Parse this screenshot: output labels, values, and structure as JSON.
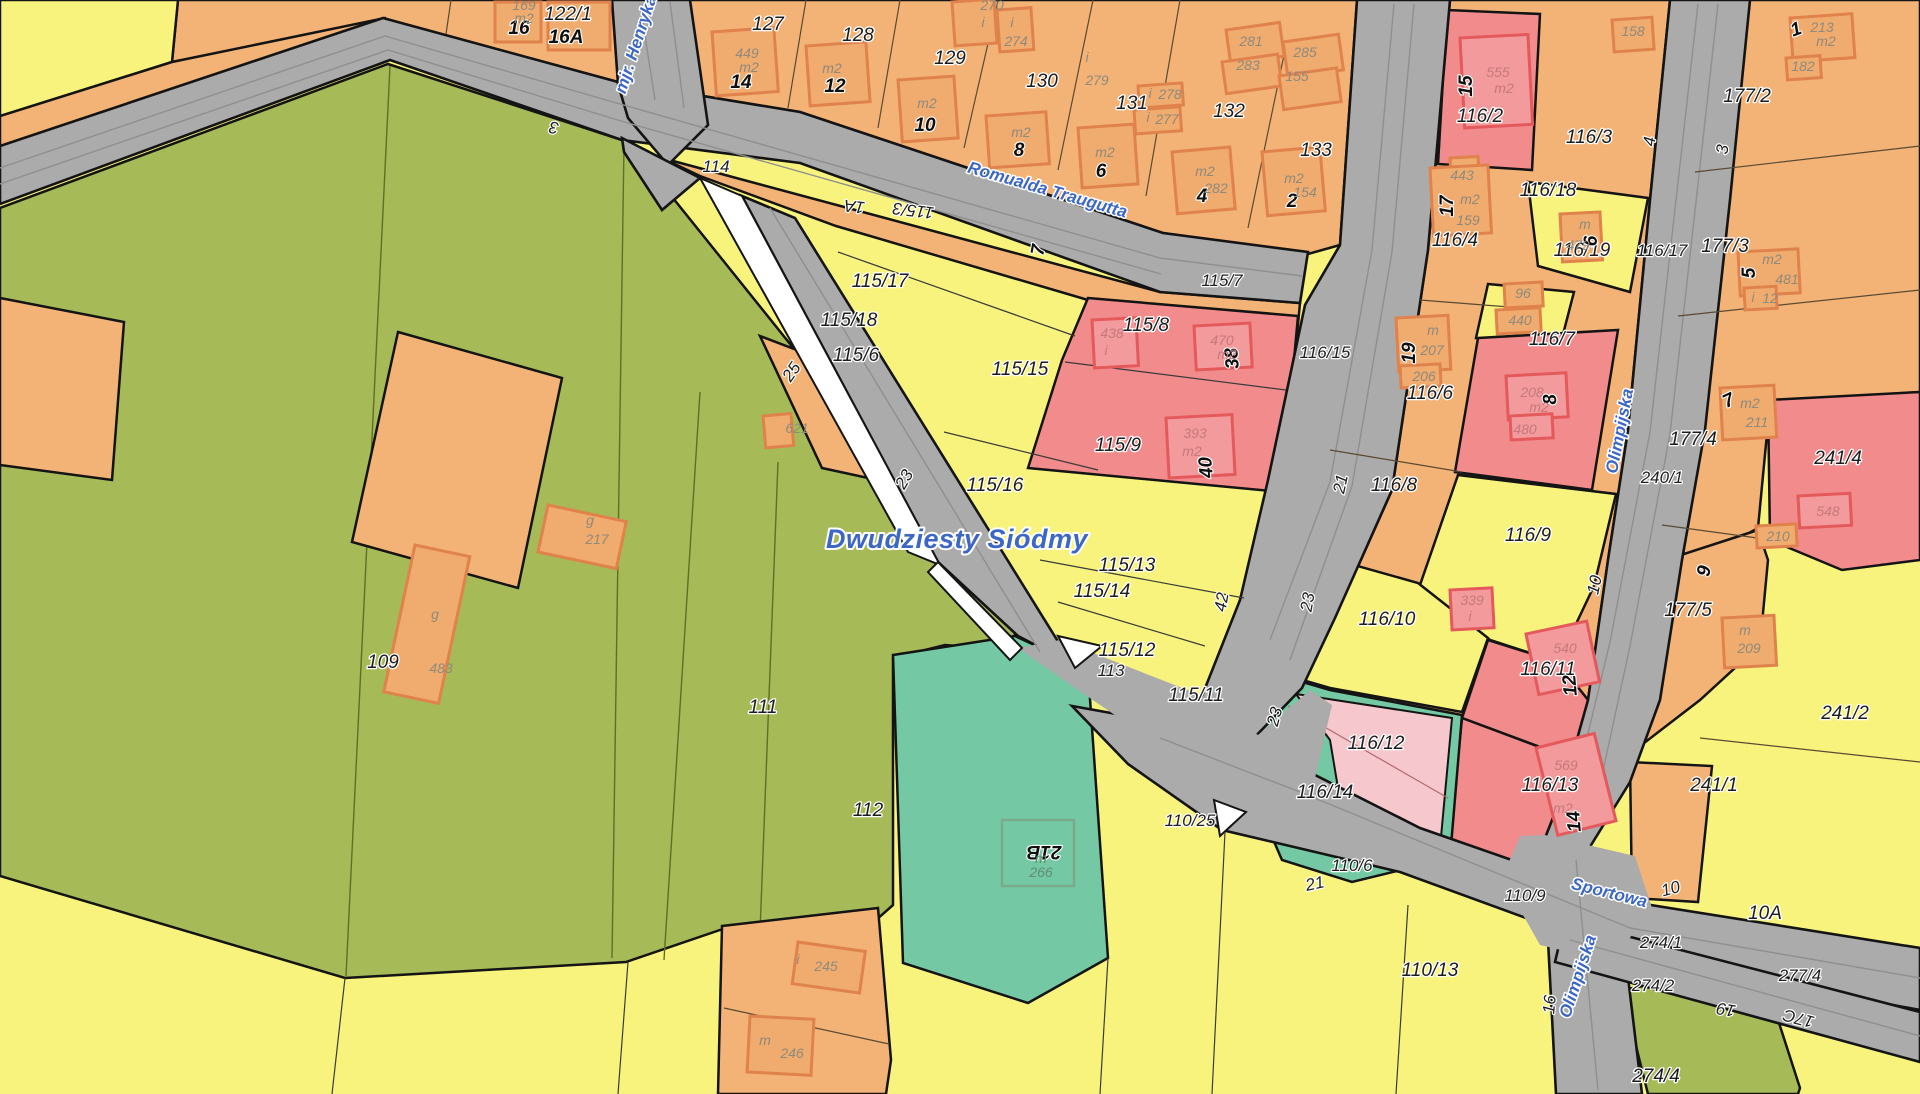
{
  "map": {
    "type": "cadastral-parcel-map",
    "district_label": {
      "text": "Dwudziesty Siódmy",
      "x": 957,
      "y": 548,
      "rot": 0
    }
  },
  "colors": {
    "parcel_yellow": "#f8f37d",
    "parcel_olive": "#a6ba58",
    "parcel_orange": "#f3b377",
    "parcel_red": "#f28b8c",
    "parcel_pink": "#f6c8ce",
    "parcel_teal": "#74c9a4",
    "road_gray": "#ababab",
    "street_text_blue": "#3c67c5",
    "building_outline": "#e0824b"
  },
  "labels": {
    "street_names": [
      [
        "mjr. Henryka",
        641,
        46,
        -72
      ],
      [
        "Romualda Traugutta",
        1046,
        195,
        16
      ],
      [
        "Olimpijska",
        1625,
        432,
        -79
      ],
      [
        "Sportowa",
        1608,
        898,
        14
      ],
      [
        "Olimpijska",
        1583,
        978,
        -72
      ]
    ],
    "district": [
      [
        "Dwudziesty Siódmy",
        957,
        548,
        0
      ]
    ],
    "parcel_numbers": [
      [
        "122/1",
        568,
        20,
        0
      ],
      [
        "127",
        768,
        30,
        0
      ],
      [
        "128",
        858,
        41,
        0
      ],
      [
        "129",
        950,
        64,
        0
      ],
      [
        "130",
        1042,
        87,
        0
      ],
      [
        "131",
        1132,
        109,
        0
      ],
      [
        "132",
        1229,
        117,
        0
      ],
      [
        "133",
        1316,
        156,
        0
      ],
      [
        "116/2",
        1480,
        122,
        0
      ],
      [
        "116/3",
        1589,
        143,
        0
      ],
      [
        "177/2",
        1747,
        102,
        0
      ],
      [
        "116/18",
        1548,
        196,
        0
      ],
      [
        "116/19",
        1582,
        256,
        0
      ],
      [
        "177/3",
        1725,
        252,
        0
      ],
      [
        "116/4",
        1455,
        246,
        0
      ],
      [
        "115/8",
        1146,
        331,
        0
      ],
      [
        "115/15",
        1020,
        375,
        0
      ],
      [
        "115/17",
        880,
        287,
        0
      ],
      [
        "115/18",
        849,
        326,
        0
      ],
      [
        "115/6",
        856,
        361,
        0
      ],
      [
        "115/9",
        1118,
        451,
        0
      ],
      [
        "116/6",
        1430,
        399,
        0
      ],
      [
        "116/7",
        1552,
        345,
        0
      ],
      [
        "116/8",
        1394,
        491,
        0
      ],
      [
        "116/9",
        1528,
        541,
        0
      ],
      [
        "116/10",
        1387,
        625,
        0
      ],
      [
        "116/11",
        1548,
        675,
        0
      ],
      [
        "116/12",
        1376,
        749,
        0
      ],
      [
        "116/13",
        1550,
        791,
        0
      ],
      [
        "116/14",
        1325,
        798,
        0
      ],
      [
        "115/16",
        995,
        491,
        0
      ],
      [
        "115/13",
        1127,
        571,
        0
      ],
      [
        "115/14",
        1102,
        597,
        0
      ],
      [
        "115/12",
        1127,
        656,
        0
      ],
      [
        "115/11",
        1196,
        701,
        0
      ],
      [
        "177/4",
        1693,
        445,
        0
      ],
      [
        "177/5",
        1688,
        616,
        0
      ],
      [
        "241/4",
        1838,
        464,
        0
      ],
      [
        "241/2",
        1845,
        719,
        0
      ],
      [
        "241/1",
        1714,
        791,
        0
      ],
      [
        "110/13",
        1430,
        976,
        0
      ],
      [
        "109",
        383,
        668,
        0
      ],
      [
        "111",
        763,
        713,
        0
      ],
      [
        "112",
        868,
        816,
        0
      ],
      [
        "10A",
        1765,
        919,
        0
      ],
      [
        "274/4",
        1656,
        1082,
        0
      ]
    ],
    "road_numbers": [
      [
        "3",
        555,
        122,
        190
      ],
      [
        "114",
        716,
        172,
        0
      ],
      [
        "1A",
        855,
        201,
        187
      ],
      [
        "115/3",
        914,
        205,
        187
      ],
      [
        "115/7",
        1222,
        286,
        0
      ],
      [
        "116/15",
        1325,
        358,
        0
      ],
      [
        "4",
        1655,
        142,
        -83
      ],
      [
        "3",
        1728,
        150,
        -83
      ],
      [
        "116/17",
        1662,
        256,
        0
      ],
      [
        "25",
        796,
        375,
        -55
      ],
      [
        "23",
        909,
        482,
        -60
      ],
      [
        "21",
        1346,
        485,
        -78
      ],
      [
        "23",
        1313,
        603,
        -80
      ],
      [
        "42",
        1227,
        603,
        -80
      ],
      [
        "113",
        1111,
        676,
        0
      ],
      [
        "23",
        1280,
        718,
        -75
      ],
      [
        "110/25",
        1190,
        826,
        0
      ],
      [
        "110/6",
        1352,
        871,
        0
      ],
      [
        "21",
        1316,
        889,
        -12
      ],
      [
        "110/9",
        1525,
        901,
        0
      ],
      [
        "240/1",
        1662,
        483,
        0
      ],
      [
        "274/1",
        1661,
        948,
        0
      ],
      [
        "274/2",
        1653,
        991,
        0
      ],
      [
        "277/4",
        1800,
        981,
        0
      ],
      [
        "10",
        1600,
        586,
        -78
      ],
      [
        "10",
        1672,
        894,
        -15
      ],
      [
        "19",
        1727,
        1004,
        190
      ],
      [
        "17C",
        1800,
        1013,
        195
      ],
      [
        "16",
        1555,
        1005,
        -85
      ]
    ],
    "addresses": [
      [
        "16",
        519,
        34,
        0
      ],
      [
        "16A",
        566,
        43,
        0
      ],
      [
        "14",
        741,
        88,
        0
      ],
      [
        "12",
        835,
        92,
        0
      ],
      [
        "10",
        925,
        131,
        0
      ],
      [
        "8",
        1019,
        156,
        0
      ],
      [
        "6",
        1101,
        177,
        0
      ],
      [
        "4",
        1202,
        202,
        0
      ],
      [
        "2",
        1292,
        207,
        0
      ],
      [
        "15",
        1472,
        86,
        -90
      ],
      [
        "17",
        1453,
        206,
        -90
      ],
      [
        "1",
        1798,
        35,
        -20
      ],
      [
        "5",
        1755,
        273,
        -90
      ],
      [
        "6",
        1597,
        241,
        -90
      ],
      [
        "19",
        1415,
        353,
        -90
      ],
      [
        "8",
        1556,
        399,
        -95
      ],
      [
        "38",
        1238,
        358,
        -95
      ],
      [
        "40",
        1212,
        467,
        -95
      ],
      [
        "7",
        1731,
        406,
        -25
      ],
      [
        "9",
        1710,
        572,
        -80
      ],
      [
        "12",
        1576,
        685,
        -95
      ],
      [
        "14",
        1580,
        821,
        -95
      ],
      [
        "21B",
        1044,
        846,
        180
      ],
      [
        "7",
        1044,
        251,
        -80
      ]
    ],
    "building_labels": [
      [
        "169",
        524,
        10,
        0
      ],
      [
        "m2",
        524,
        23,
        0
      ],
      [
        "449",
        747,
        58,
        0
      ],
      [
        "m2",
        749,
        72,
        0
      ],
      [
        "m2",
        832,
        73,
        0
      ],
      [
        "m2",
        927,
        108,
        0
      ],
      [
        "270",
        992,
        10,
        0
      ],
      [
        "i",
        983,
        27,
        0
      ],
      [
        "i",
        1012,
        27,
        0
      ],
      [
        "274",
        1016,
        46,
        0
      ],
      [
        "i",
        1087,
        62,
        0
      ],
      [
        "279",
        1097,
        85,
        0
      ],
      [
        "i",
        1150,
        98,
        0
      ],
      [
        "278",
        1170,
        99,
        0
      ],
      [
        "i",
        1148,
        122,
        0
      ],
      [
        "277",
        1167,
        124,
        0
      ],
      [
        "m2",
        1021,
        137,
        0
      ],
      [
        "m2",
        1105,
        157,
        0
      ],
      [
        "281",
        1251,
        46,
        0
      ],
      [
        "283",
        1248,
        70,
        0
      ],
      [
        "285",
        1305,
        57,
        0
      ],
      [
        "155",
        1297,
        81,
        0
      ],
      [
        "m2",
        1205,
        176,
        0
      ],
      [
        "282",
        1216,
        193,
        0
      ],
      [
        "m2",
        1294,
        183,
        0
      ],
      [
        "154",
        1305,
        197,
        0
      ],
      [
        "158",
        1633,
        36,
        0
      ],
      [
        "213",
        1822,
        32,
        0
      ],
      [
        "m2",
        1826,
        46,
        0
      ],
      [
        "182",
        1803,
        71,
        0
      ],
      [
        "443",
        1462,
        180,
        0
      ],
      [
        "m2",
        1470,
        204,
        0
      ],
      [
        "159",
        1468,
        225,
        0
      ],
      [
        "m",
        1585,
        229,
        0
      ],
      [
        "479",
        1578,
        250,
        0
      ],
      [
        "m2",
        1772,
        264,
        0
      ],
      [
        "481",
        1787,
        284,
        0
      ],
      [
        "i",
        1753,
        302,
        0
      ],
      [
        "12",
        1770,
        303,
        0
      ],
      [
        "96",
        1523,
        298,
        0
      ],
      [
        "440",
        1520,
        325,
        0
      ],
      [
        "m",
        1433,
        335,
        0
      ],
      [
        "207",
        1432,
        355,
        0
      ],
      [
        "206",
        1424,
        381,
        0
      ],
      [
        "m2",
        1750,
        408,
        0
      ],
      [
        "211",
        1757,
        427,
        0
      ],
      [
        "m",
        1745,
        635,
        0
      ],
      [
        "209",
        1749,
        653,
        0
      ],
      [
        "210",
        1778,
        541,
        0
      ],
      [
        "621",
        797,
        433,
        0
      ],
      [
        "g",
        590,
        525,
        0
      ],
      [
        "217",
        597,
        544,
        0
      ],
      [
        "g",
        435,
        619,
        0
      ],
      [
        "483",
        441,
        673,
        0
      ],
      [
        "i",
        798,
        964,
        0
      ],
      [
        "245",
        826,
        971,
        0
      ],
      [
        "m",
        765,
        1045,
        0
      ],
      [
        "246",
        792,
        1058,
        0
      ]
    ],
    "building_labels_red": [
      [
        "555",
        1498,
        77,
        0
      ],
      [
        "m2",
        1504,
        93,
        0
      ],
      [
        "470",
        1222,
        345,
        0
      ],
      [
        "m2",
        1227,
        359,
        0
      ],
      [
        "438",
        1112,
        338,
        0
      ],
      [
        "i",
        1106,
        355,
        0
      ],
      [
        "393",
        1195,
        438,
        0
      ],
      [
        "m2",
        1192,
        456,
        0
      ],
      [
        "339",
        1472,
        605,
        0
      ],
      [
        "i",
        1470,
        621,
        0
      ],
      [
        "540",
        1565,
        653,
        0
      ],
      [
        "569",
        1566,
        770,
        0
      ],
      [
        "m2",
        1563,
        813,
        0
      ],
      [
        "208",
        1532,
        397,
        0
      ],
      [
        "m2",
        1539,
        412,
        0
      ],
      [
        "480",
        1525,
        434,
        0
      ],
      [
        "548",
        1828,
        516,
        0
      ]
    ],
    "building_labels_teal": [
      [
        "m",
        1041,
        863,
        0
      ],
      [
        "266",
        1041,
        877,
        0
      ]
    ]
  }
}
